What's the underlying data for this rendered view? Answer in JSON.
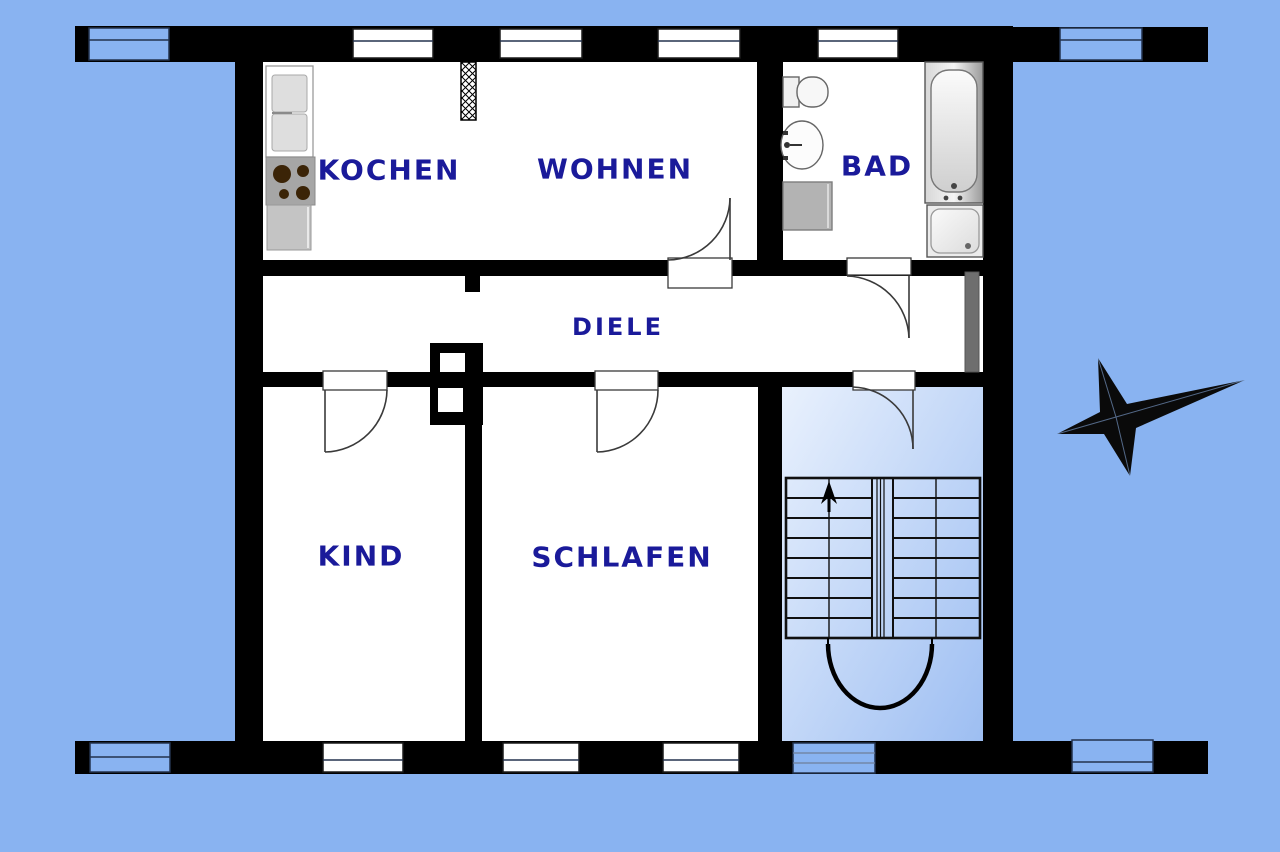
{
  "plan": {
    "title": "apartment-floor-plan",
    "rooms": {
      "kochen": {
        "label": "KOCHEN"
      },
      "wohnen": {
        "label": "WOHNEN"
      },
      "bad": {
        "label": "BAD"
      },
      "diele": {
        "label": "DIELE"
      },
      "kind": {
        "label": "KIND"
      },
      "schlafen": {
        "label": "SCHLAFEN"
      }
    }
  },
  "colors": {
    "bg": "#89b3f1",
    "wall": "#000000",
    "room": "#ffffff",
    "label": "#1a1a9a",
    "stair-light": "#e9f1fd",
    "stair-dark": "#9dbef2",
    "fixture-gray": "#b3b3b3",
    "burner-brown": "#3b2407",
    "wardrobe-gray": "#6e6e6e"
  },
  "icons": {
    "compass-star": "four-pointed compass rose, long point to east",
    "stairs-up-arrow": "arrow marking stair direction up",
    "chimney-hatch": "cross-hatched flue block"
  }
}
